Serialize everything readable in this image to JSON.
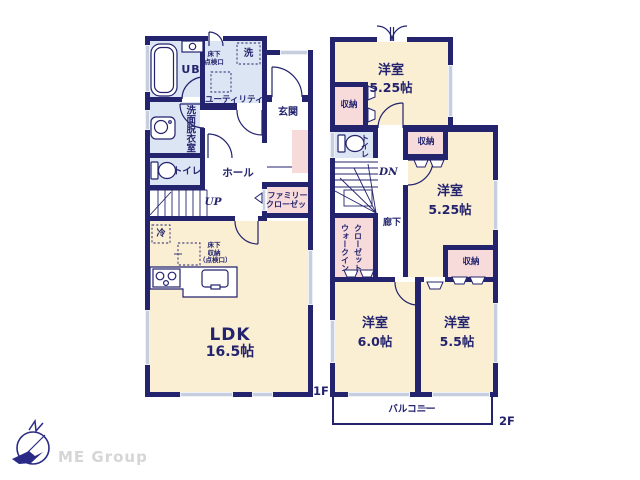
{
  "colors": {
    "navy": "#23236e",
    "cream": "#faeed3",
    "blue": "#dbe5f3",
    "pink": "#f6dbda",
    "wingray": "#c7cede",
    "logonavy": "#2b2b87",
    "logogray": "#d6d6d6"
  },
  "f1": {
    "floor": "1F",
    "ub": "UB",
    "utility": "ユーティリティ",
    "wash": "洗",
    "hatch1": "床下",
    "hatch2": "点検口",
    "genkan": "玄関",
    "washroom": "洗面脱衣室",
    "toilet": "トイレ",
    "hall": "ホール",
    "fc1": "ファミリー",
    "fc2": "クローゼット",
    "up": "UP",
    "fridge": "冷",
    "fs1": "床下",
    "fs2": "収納",
    "fs3": "（点検口）",
    "ldk": "LDK",
    "ldk_size": "16.5帖"
  },
  "f2": {
    "floor": "2F",
    "bed1": "洋室",
    "bed1_size": "5.25帖",
    "bed2": "洋室",
    "bed2_size": "5.25帖",
    "bed3": "洋室",
    "bed3_size": "6.0帖",
    "bed4": "洋室",
    "bed4_size": "5.5帖",
    "storage1": "収納",
    "storage2": "収納",
    "storage3": "収納",
    "toilet": "トイレ",
    "dn": "DN",
    "hallway": "廊下",
    "wic1": "ウォークイン",
    "wic2": "クローゼット",
    "balcony": "バルコニー"
  },
  "logo": {
    "company": "ME Group"
  }
}
